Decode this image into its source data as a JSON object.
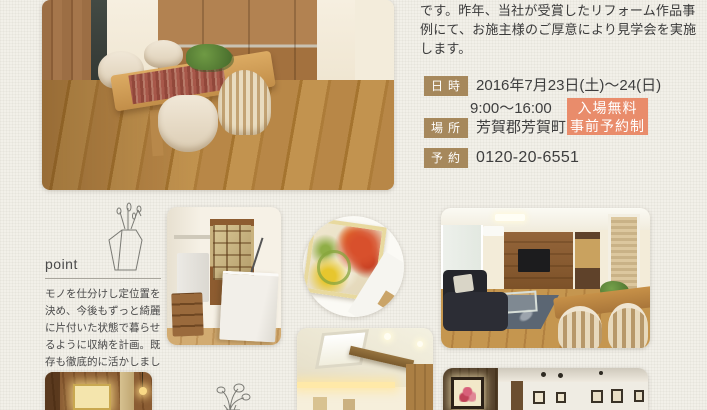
{
  "intro": {
    "text": "です。昨年、当社が受賞したリフォーム作品事例にて、お施主様のご厚意により見学会を実施します。"
  },
  "details": {
    "date_label": "日時",
    "date_value": "2016年7月23日(土)〜24(日)",
    "time_value": "9:00〜16:00",
    "place_label": "場所",
    "place_value": "芳賀郡芳賀町",
    "reserve_label": "予約",
    "reserve_value": "0120-20-6551"
  },
  "badge": {
    "line1": "入場無料",
    "line2": "事前予約制"
  },
  "point": {
    "title": "point",
    "body": "モノを仕分けし定位置を決め、今後もずっと綺麗に片付いた状態で暮らせるように収納を計画。既存も徹底的に活かしました。"
  },
  "colors": {
    "background": "#f2f0e9",
    "label_brown": "#a6885c",
    "badge_orange": "#e98c6b",
    "text_dark": "#3a3a3a"
  }
}
